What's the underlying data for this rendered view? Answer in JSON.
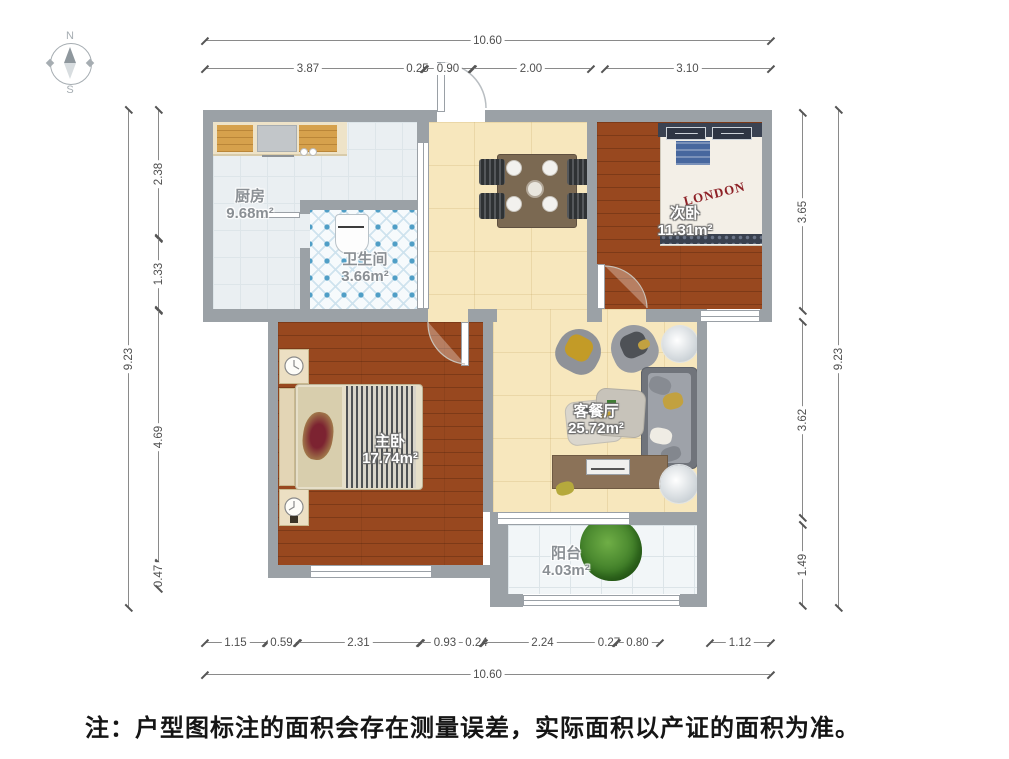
{
  "note": {
    "text": "注：户型图标注的面积会存在测量误差，实际面积以产证的面积为准。"
  },
  "compass": {
    "north": "N",
    "south": "S"
  },
  "rooms": {
    "kitchen": {
      "name": "厨房",
      "area": "9.68m²"
    },
    "bathroom": {
      "name": "卫生间",
      "area": "3.66m²"
    },
    "second_bedroom": {
      "name": "次卧",
      "area": "11.31m²",
      "bed_text": "LONDON"
    },
    "master_bedroom": {
      "name": "主卧",
      "area": "17.74m²"
    },
    "living_dining": {
      "name": "客餐厅",
      "area": "25.72m²"
    },
    "balcony": {
      "name": "阳台",
      "area": "4.03m²"
    }
  },
  "dimensions": {
    "top": {
      "total": "10.60",
      "segments": [
        "3.87",
        "0.25",
        "0.90",
        "2.00",
        "3.10"
      ]
    },
    "bottom": {
      "total": "10.60",
      "segments": [
        "1.15",
        "0.59",
        "2.31",
        "0.93",
        "0.24",
        "2.24",
        "0.27",
        "0.80",
        "1.12"
      ]
    },
    "left": {
      "total": "9.23",
      "segments": [
        "2.38",
        "1.33",
        "4.69",
        "0.47"
      ]
    },
    "right": {
      "total": "9.23",
      "segments": [
        "3.65",
        "3.62",
        "1.49"
      ]
    }
  },
  "colors": {
    "wall": "#9ba1a6",
    "wood_floor": "#98481f",
    "cream_floor": "#f7e7bd",
    "kitchen_tile": "#eaeff2",
    "bath_accent": "#4f9ec6",
    "bed_text_red": "#8d2026"
  }
}
